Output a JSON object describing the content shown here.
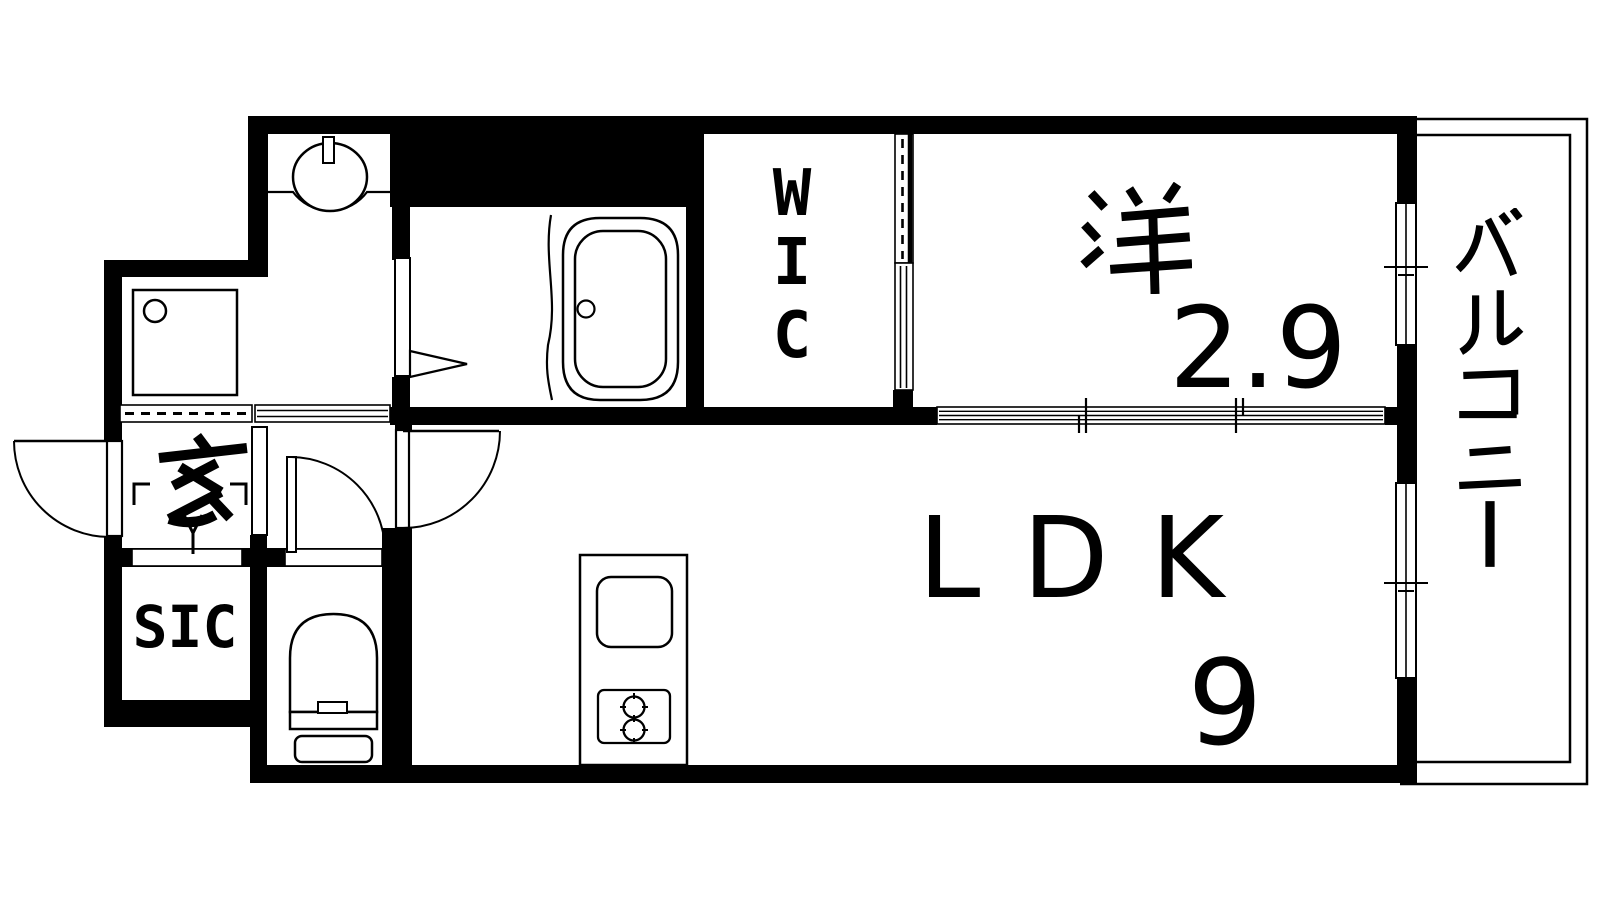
{
  "plan": {
    "kind": "apartment floor plan",
    "colors": {
      "line": "#000000",
      "background": "#ffffff"
    }
  },
  "rooms": {
    "genkan": {
      "label": "玄"
    },
    "sic": {
      "label": "SIC"
    },
    "wic": {
      "label": "WIC",
      "chars": [
        "W",
        "I",
        "C"
      ]
    },
    "western_room": {
      "label": "洋",
      "size": "2.9"
    },
    "ldk": {
      "label": "LDK",
      "size": "9"
    },
    "balcony": {
      "label": "バルコニー",
      "chars": [
        "バ",
        "ル",
        "コ",
        "ニ",
        "ー"
      ]
    }
  },
  "icons": [
    "bathtub-icon",
    "washbasin-icon",
    "washing-machine-pan-icon",
    "toilet-icon",
    "kitchen-sink-icon",
    "gas-stove-icon",
    "entrance-door-swing-icon",
    "toilet-door-swing-icon",
    "ldk-door-swing-icon",
    "bathroom-folding-door-icon",
    "washroom-sliding-door-icon",
    "wic-sliding-door-icon",
    "three-panel-sliding-door-icon",
    "balcony-window-icon",
    "genkan-step-marks-icon"
  ]
}
